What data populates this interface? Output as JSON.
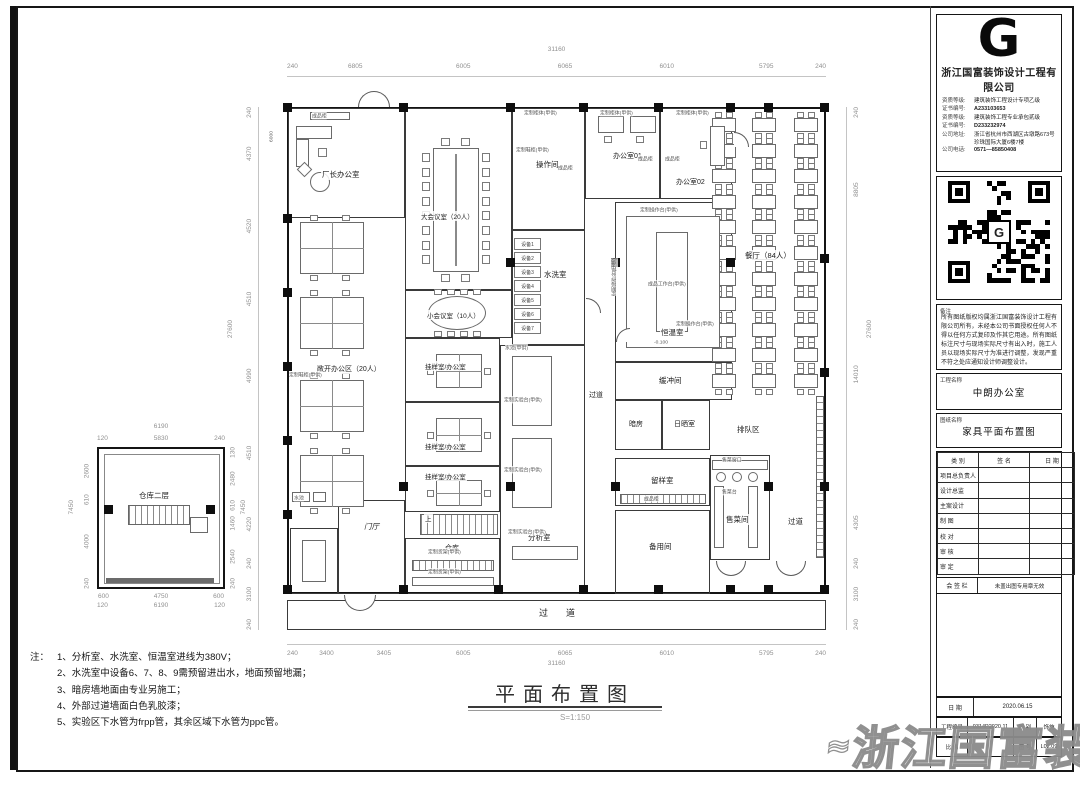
{
  "sheet": {
    "company": {
      "logo_letter": "G",
      "name": "浙江国富装饰设计工程有限公司",
      "cred1_label": "资质等级:",
      "cred1": "建筑装饰工程设计专项乙级",
      "cred1_no_label": "证书编号:",
      "cred1_no": "A233103653",
      "cred2_label": "资质等级:",
      "cred2": "建筑装饰工程专业承包贰级",
      "cred2_no_label": "证书编号:",
      "cred2_no": "D233232974",
      "addr_label": "公司地址:",
      "addr": "浙江省杭州市西湖区古墩路673号珍珠国际大厦6楼7楼",
      "tel_label": "公司电话:",
      "tel": "0571—85850408"
    },
    "remark": {
      "label": "备注",
      "text": "所有图纸版权均属浙江国富装饰设计工程有限公司所有，未经本公司书面授权任何人不得以任何方式复印及作其它用途。所有图纸标注尺寸与现场实际尺寸有出入时，施工人员以现场实际尺寸为准进行调整，发现严重不符之处应通知设计师调整设计。"
    },
    "project": {
      "label": "工程名称",
      "value": "中朗办公室"
    },
    "drawing": {
      "label": "图纸名称",
      "value": "家具平面布置图"
    },
    "sig_table": {
      "headers": [
        "类  别",
        "签  名",
        "日  期"
      ],
      "rows": [
        "项目总负责人",
        "设计总监",
        "主案设计",
        "制  图",
        "校  对",
        "审  核",
        "审  定"
      ]
    },
    "huiqian": {
      "label": "会  签  栏",
      "note": "未盖出图专用章无效"
    },
    "date_row": {
      "label": "日  期",
      "value": "2020.06.15"
    },
    "no_row": {
      "label": "工程编号",
      "value": "0314P2020.11",
      "type_label": "图  别",
      "type_value": "饰施"
    },
    "scale_row": {
      "label": "比  例",
      "value": "",
      "no_label": "图  号",
      "no_value": "L02.09"
    },
    "watermark": "浙江国富装饰"
  },
  "plan": {
    "title": "平面布置图",
    "scale": "S=1:150",
    "rooms": {
      "changzhang": "厂长办公室",
      "open_office": "敞开办公区（20人）",
      "conference": "大会议室（20人）",
      "small_meeting": "小会议室（10人）",
      "caozuo": "操作间",
      "office01": "办公室01",
      "office02": "办公室02",
      "xixi": "水洗室",
      "hengwen": "恒温室",
      "huanchong": "缓冲间",
      "canting": "餐厅（84人）",
      "anfang": "暗房",
      "rishai": "日晒室",
      "paidui": "排队区",
      "liuyang": "留样室",
      "beiyong": "备用间",
      "shoucai": "售菜间",
      "guayang": "挂样室/办公室",
      "menting": "门厅",
      "cangku": "仓库",
      "fenxi": "分析室",
      "corridor": "过道",
      "shang": "上"
    },
    "annotations": [
      "成品柜",
      "定制柜体(甲供)",
      "定制柜体(甲供)",
      "定制柜体(甲供)",
      "定制鞋柜(甲供)",
      "定制鞋柜(甲供)",
      "成品柜",
      "成品柜",
      "成品柜",
      "定制操作台(甲供)",
      "成品工作台(甲供)",
      "定制操作台(甲供)",
      "定制操作台(甲供)",
      "水池(甲供)",
      "定制实验台(甲供)",
      "定制实验台(甲供)",
      "定制实验台(甲供)",
      "定制货架(甲供)",
      "定制货架(甲供)",
      "成品柜",
      "售菜窗口",
      "售菜台",
      "水池",
      "-0.100"
    ],
    "equipment": [
      "设备1",
      "设备2",
      "设备3",
      "设备4",
      "设备5",
      "设备6",
      "设备7"
    ],
    "dims": {
      "top_total": "31160",
      "top": [
        "240",
        "6805",
        "6005",
        "6065",
        "6010",
        "5795",
        "240"
      ],
      "bottom": [
        "240",
        "3400",
        "3405",
        "6005",
        "6065",
        "6010",
        "5795",
        "240"
      ],
      "bottom_total": "31160",
      "left": [
        "240",
        "4370",
        "4520",
        "4510",
        "4990",
        "4510",
        "4220",
        "240",
        "3100",
        "240"
      ],
      "left_total": "27600",
      "right": [
        "240",
        "8805",
        "14010",
        "4305",
        "240",
        "3100",
        "240"
      ],
      "right_total": "27600",
      "inner": "6000"
    }
  },
  "small_plan": {
    "label": "仓库二层",
    "dims": {
      "top_total": "6190",
      "top": [
        "120",
        "5830",
        "240"
      ],
      "bottom1": [
        "600",
        "4750",
        "600"
      ],
      "bottom2": [
        "120",
        "6190",
        "120"
      ],
      "left": [
        "2600",
        "610",
        "4000",
        "240"
      ],
      "left_total": "7450",
      "right": [
        "130",
        "2480",
        "610",
        "1460",
        "2540",
        "240"
      ],
      "right_total": "7450"
    }
  },
  "notes": {
    "prefix": "注：",
    "items": [
      "1、分析室、水洗室、恒温室进线为380V；",
      "2、水洗室中设备6、7、8、9需预留进出水，地面预留地漏；",
      "3、暗房墙地面由专业另施工；",
      "4、外部过道墙面白色乳胶漆；",
      "5、实验区下水管为frpp管，其余区域下水管为ppc管。"
    ]
  }
}
